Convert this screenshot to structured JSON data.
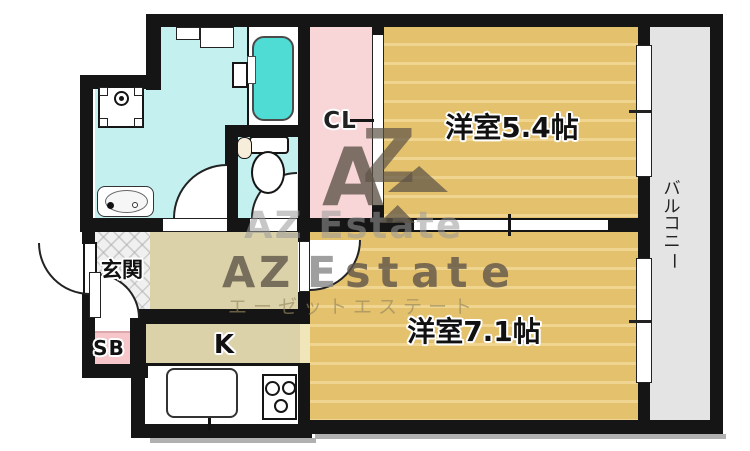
{
  "rooms": {
    "entrance": "玄関",
    "shoe_box": "SB",
    "kitchen": "K",
    "closet": "CL",
    "bedroom_upper": "洋室5.4帖",
    "bedroom_lower": "洋室7.1帖",
    "balcony": "バルコニー"
  },
  "watermark": {
    "logo_a": "A",
    "logo_z": "Z",
    "brand_row": [
      "A",
      "Z",
      "E",
      "s",
      "t",
      "a",
      "t",
      "e"
    ],
    "brand_gray": "AZ Estate",
    "brand_katakana": "エーゼットエステート"
  },
  "colors": {
    "wall": "#151515",
    "water_room": "#c5f0f0",
    "bathtub": "#4fdcd4",
    "closet_pink": "#f8d6d8",
    "shoebox_pink": "#f6c6ca",
    "bedroom_tan": "#e4c16c",
    "bedroom_stripe": "#efd58f",
    "hallway_beige": "#dcd2a9",
    "balcony_gray": "#e4e4e4"
  }
}
